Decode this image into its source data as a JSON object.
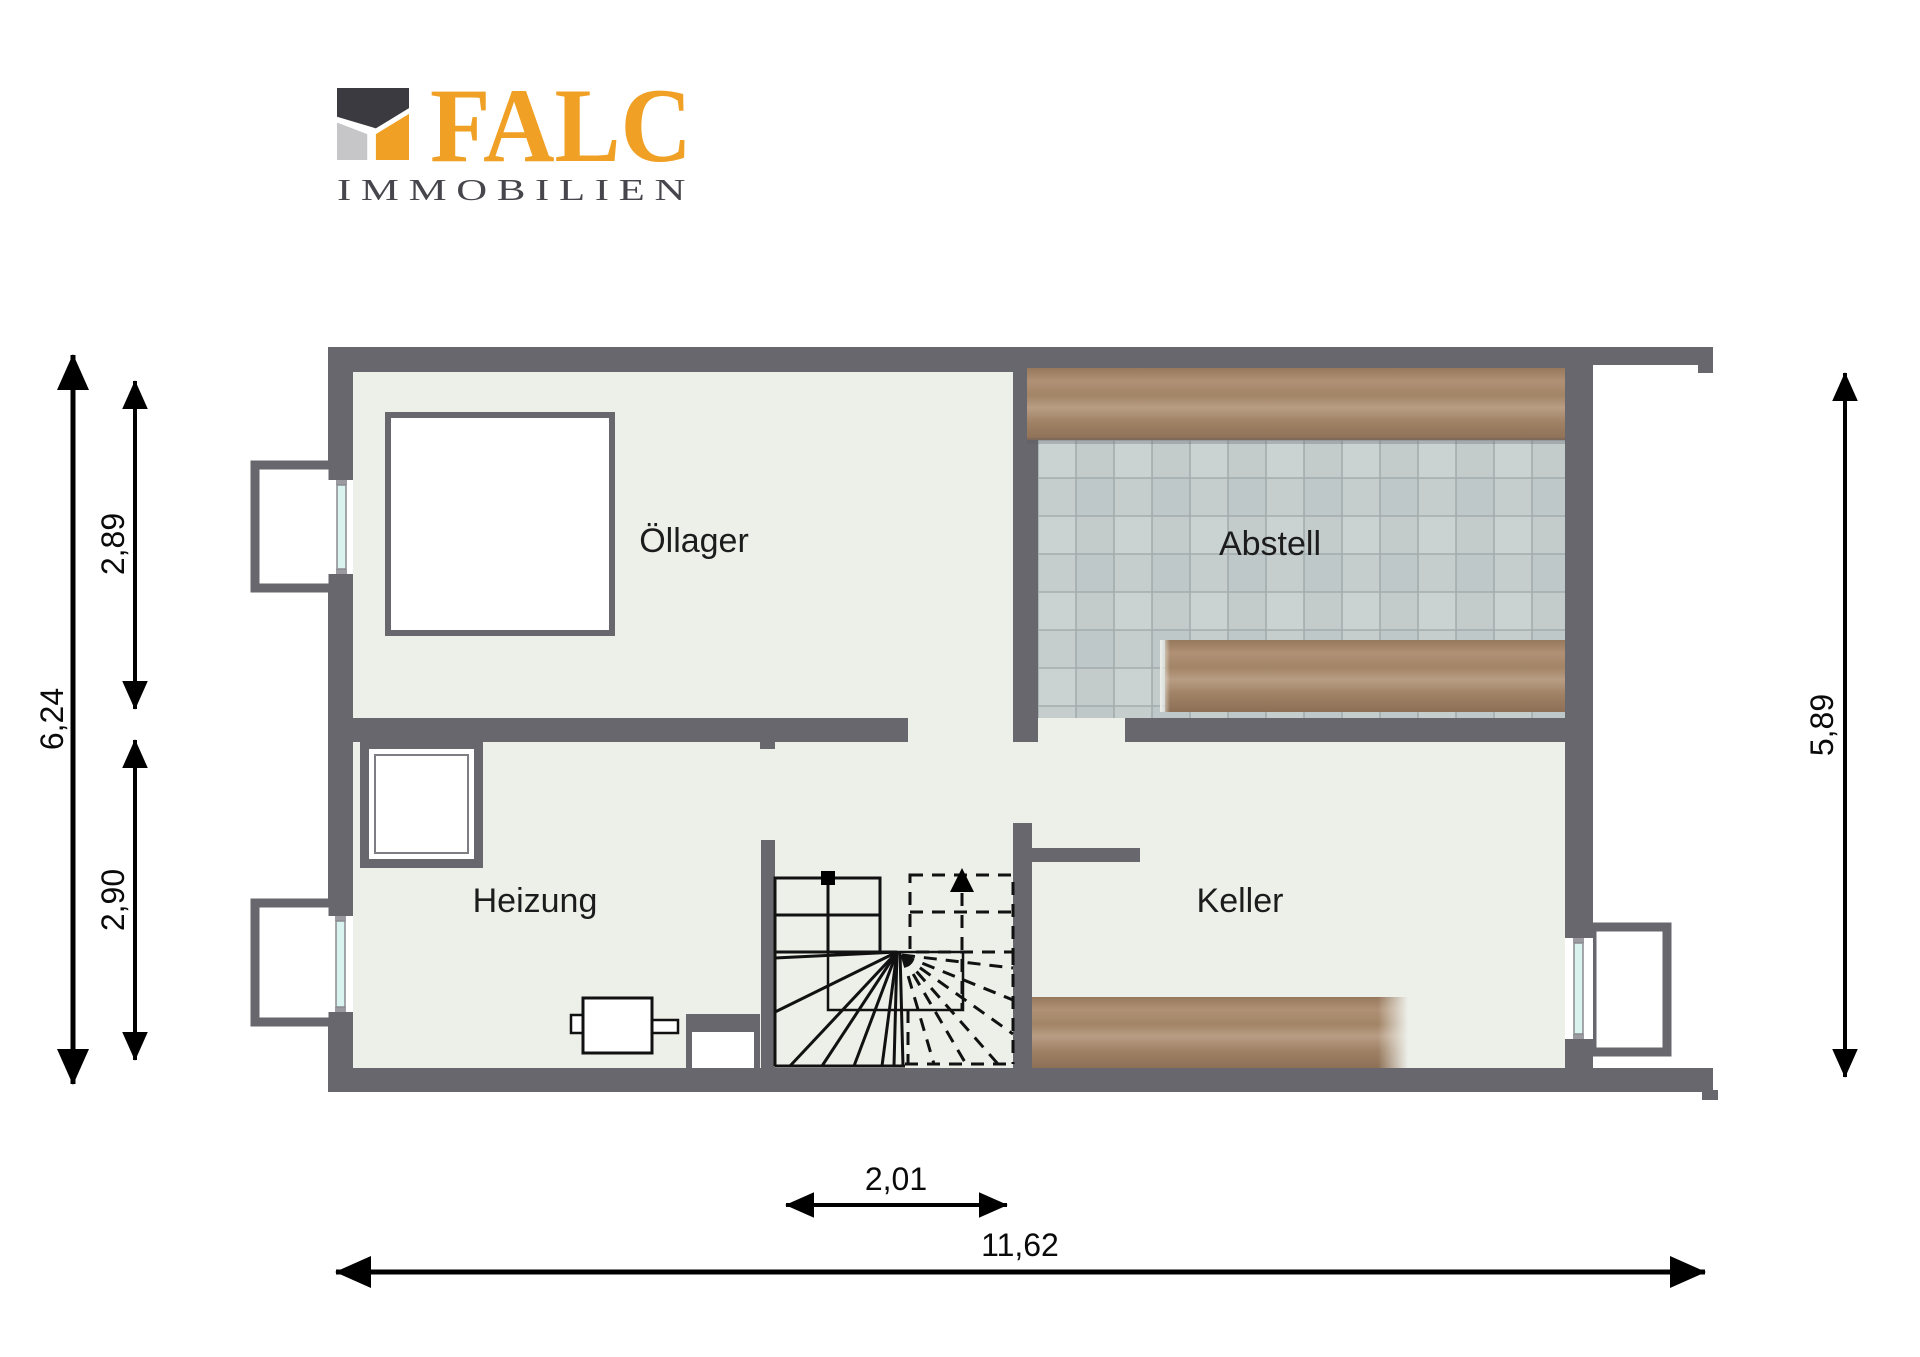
{
  "brand": {
    "name": "FALC",
    "subtitle": "IMMOBILIEN"
  },
  "floorplan": {
    "rooms": [
      {
        "label": "Öllager"
      },
      {
        "label": "Abstell"
      },
      {
        "label": "Heizung"
      },
      {
        "label": "Keller"
      }
    ],
    "dimensions": {
      "left_total": "6,24",
      "left_upper": "2,89",
      "left_lower": "2,90",
      "right_total": "5,89",
      "stairs_width": "2,01",
      "bottom_total": "11,62"
    },
    "markers": {
      "stairs_up_arrow": "▲",
      "stairs_entry_square": "■"
    }
  },
  "colors": {
    "logo_orange": "#F0A125",
    "logo_dark": "#3A3A40",
    "logo_gray": "#C6C6C8",
    "subtitle_gray": "#46464C",
    "wall": "#67676D",
    "floor": "#EDEFE9",
    "tile": "#CBD2D2",
    "tile_alt": "#C2CACA",
    "wood": "#A9896C",
    "window_glass": "#D9F3EF",
    "dimension_line": "#000000"
  }
}
